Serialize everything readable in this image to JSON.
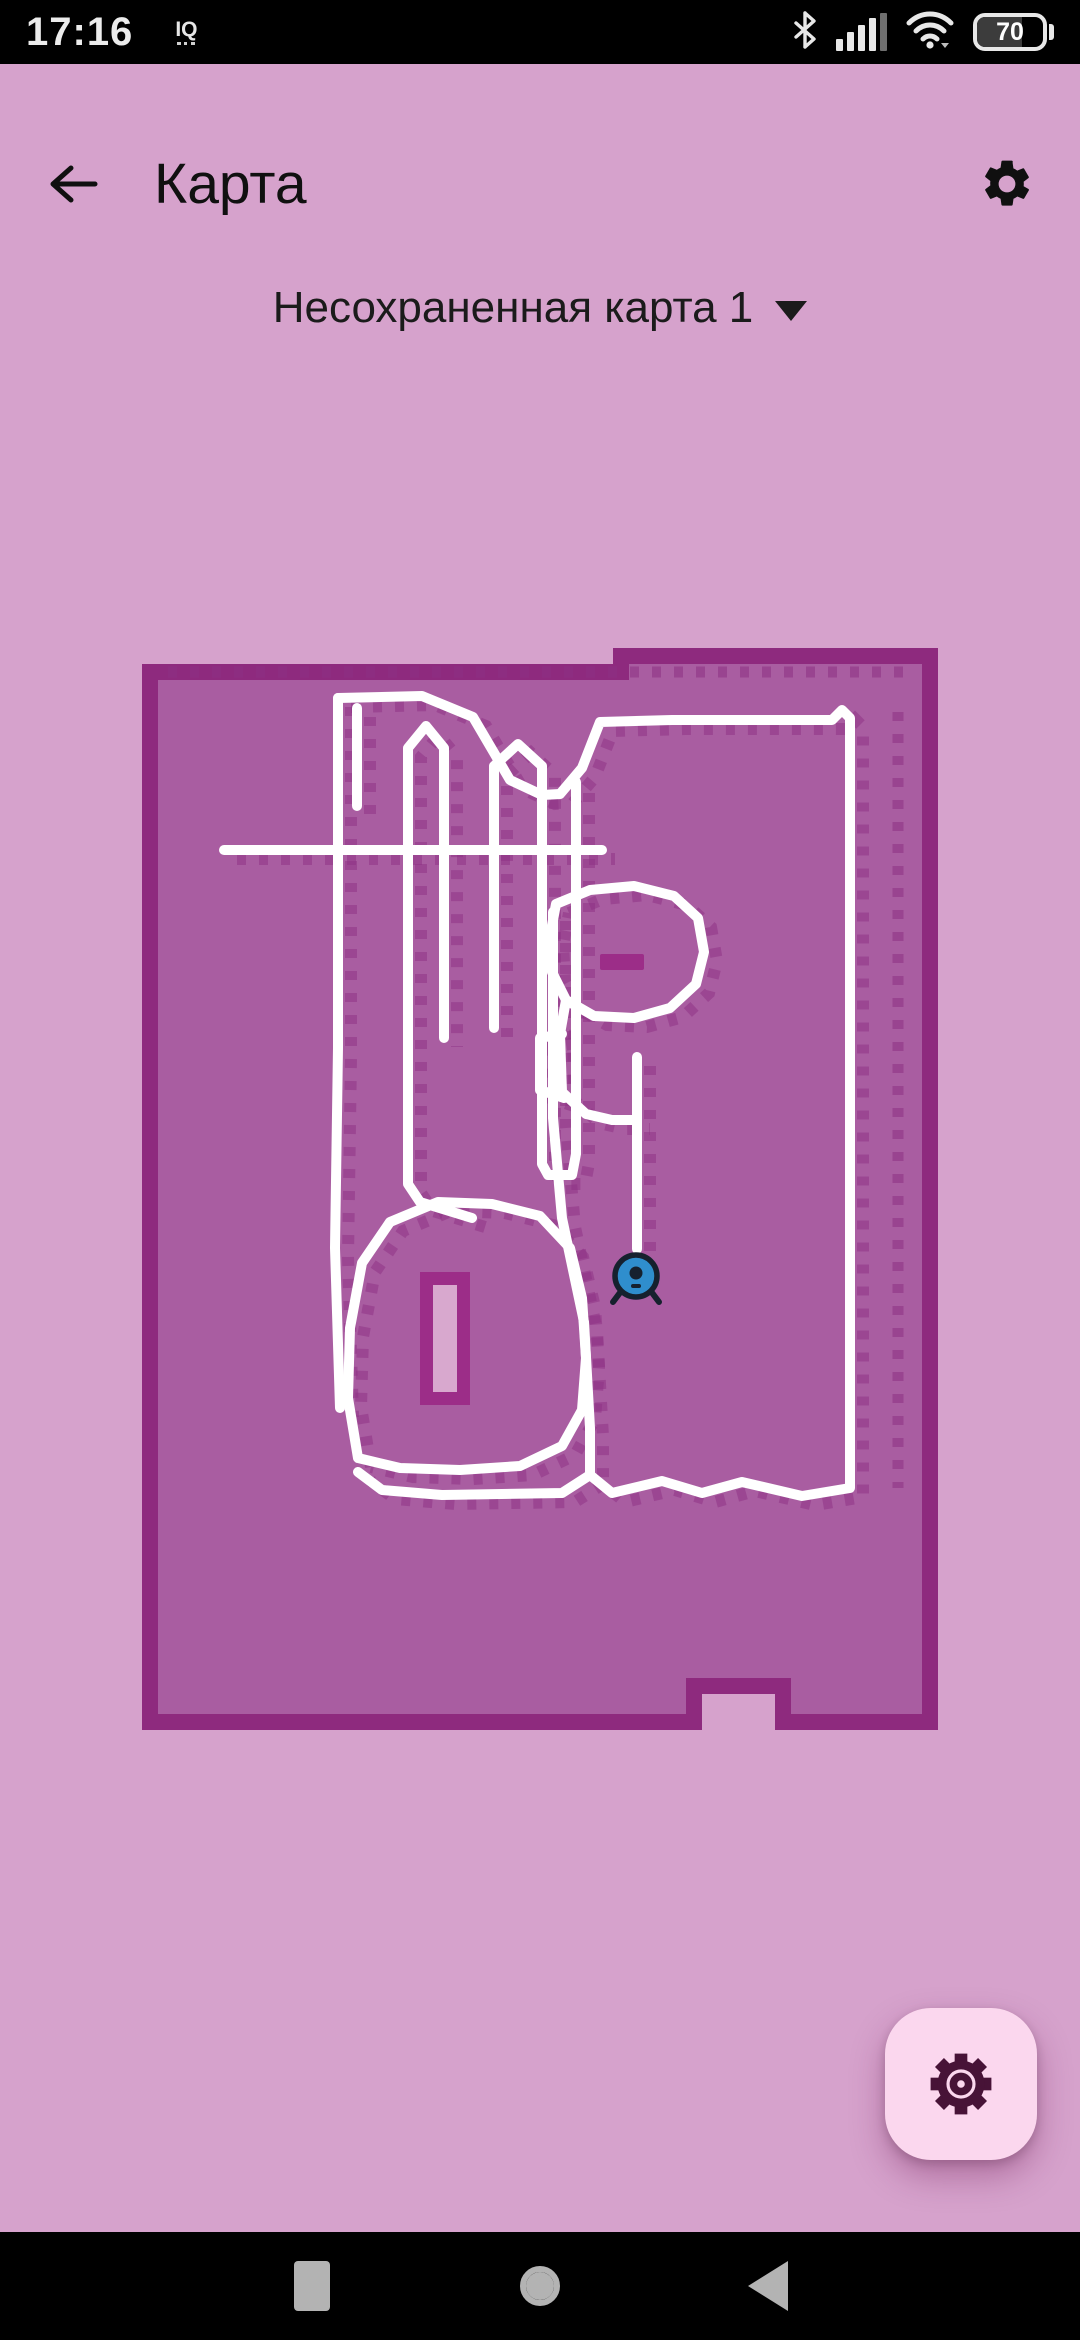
{
  "status_bar": {
    "time": "17:16",
    "notification": "IQ",
    "battery_percent": "70"
  },
  "header": {
    "title": "Карта"
  },
  "map_selector": {
    "label": "Несохраненная карта 1"
  },
  "map": {
    "colors": {
      "background": "#d6a2cc",
      "fill": "#a95da1",
      "border": "#8e2a7e",
      "path": "#ffffff",
      "texture": "#8d3084",
      "island_accent": "#9c2d88",
      "island_inner": "#d8a8ce",
      "robot_blue": "#2f8ecd",
      "robot_dark": "#16212e"
    },
    "outline_outer": [
      [
        0,
        16
      ],
      [
        471,
        16
      ],
      [
        471,
        0
      ],
      [
        796,
        0
      ],
      [
        796,
        1082
      ],
      [
        633,
        1082
      ],
      [
        633,
        1046
      ],
      [
        560,
        1046
      ],
      [
        560,
        1082
      ],
      [
        0,
        1082
      ]
    ],
    "outline_inner": [
      [
        16,
        32
      ],
      [
        487,
        32
      ],
      [
        487,
        16
      ],
      [
        780,
        16
      ],
      [
        780,
        1066
      ],
      [
        649,
        1066
      ],
      [
        649,
        1030
      ],
      [
        544,
        1030
      ],
      [
        544,
        1066
      ],
      [
        16,
        1066
      ]
    ],
    "texture_lines": [
      {
        "points": [
          [
            26,
            24
          ],
          [
            768,
            24
          ]
        ]
      },
      {
        "points": [
          [
            756,
            64
          ],
          [
            756,
            840
          ]
        ]
      }
    ],
    "path_polylines": [
      {
        "name": "outer-loop",
        "points": [
          [
            196,
            50
          ],
          [
            280,
            48
          ],
          [
            331,
            69
          ],
          [
            368,
            132
          ],
          [
            400,
            147
          ],
          [
            418,
            146
          ],
          [
            440,
            120
          ],
          [
            458,
            74
          ],
          [
            530,
            72
          ],
          [
            690,
            72
          ],
          [
            700,
            62
          ],
          [
            708,
            70
          ],
          [
            708,
            840
          ],
          [
            660,
            848
          ],
          [
            600,
            834
          ],
          [
            560,
            845
          ],
          [
            520,
            833
          ],
          [
            470,
            845
          ],
          [
            448,
            827
          ]
        ]
      },
      {
        "name": "bottom-line",
        "points": [
          [
            448,
            827
          ],
          [
            420,
            845
          ],
          [
            300,
            847
          ],
          [
            240,
            842
          ],
          [
            216,
            824
          ]
        ]
      },
      {
        "name": "left-vertical",
        "points": [
          [
            196,
            50
          ],
          [
            196,
            400
          ],
          [
            193,
            600
          ],
          [
            198,
            760
          ]
        ]
      },
      {
        "name": "left-vertical-2",
        "points": [
          [
            215,
            60
          ],
          [
            215,
            158
          ]
        ]
      },
      {
        "name": "stripe-1",
        "points": [
          [
            330,
            570
          ],
          [
            278,
            554
          ],
          [
            266,
            536
          ],
          [
            266,
            100
          ],
          [
            284,
            78
          ],
          [
            302,
            100
          ],
          [
            302,
            390
          ]
        ]
      },
      {
        "name": "stripe-2",
        "points": [
          [
            352,
            380
          ],
          [
            352,
            118
          ],
          [
            376,
            96
          ],
          [
            400,
            118
          ],
          [
            400,
            516
          ],
          [
            406,
            527
          ],
          [
            430,
            527
          ],
          [
            434,
            506
          ],
          [
            434,
            134
          ]
        ]
      },
      {
        "name": "mid-horizontal",
        "points": [
          [
            82,
            202
          ],
          [
            460,
            202
          ]
        ]
      },
      {
        "name": "center-slant",
        "points": [
          [
            411,
            264
          ],
          [
            411,
            470
          ],
          [
            420,
            570
          ],
          [
            442,
            674
          ],
          [
            448,
            780
          ],
          [
            448,
            827
          ]
        ]
      },
      {
        "name": "island-loop",
        "points": [
          [
            414,
            256
          ],
          [
            448,
            242
          ],
          [
            492,
            238
          ],
          [
            532,
            248
          ],
          [
            556,
            270
          ],
          [
            562,
            304
          ],
          [
            554,
            336
          ],
          [
            528,
            360
          ],
          [
            492,
            370
          ],
          [
            452,
            368
          ],
          [
            424,
            352
          ],
          [
            410,
            324
          ],
          [
            408,
            288
          ],
          [
            414,
            256
          ]
        ]
      },
      {
        "name": "island-notch",
        "points": [
          [
            420,
            386
          ],
          [
            398,
            390
          ],
          [
            398,
            442
          ],
          [
            422,
            450
          ]
        ]
      },
      {
        "name": "island-connector",
        "points": [
          [
            424,
            352
          ],
          [
            418,
            386
          ],
          [
            420,
            444
          ],
          [
            444,
            466
          ],
          [
            470,
            472
          ],
          [
            495,
            472
          ]
        ]
      },
      {
        "name": "robot-line",
        "points": [
          [
            495,
            409
          ],
          [
            495,
            601
          ]
        ]
      },
      {
        "name": "blob-loop",
        "points": [
          [
            216,
            810
          ],
          [
            206,
            750
          ],
          [
            208,
            680
          ],
          [
            220,
            615
          ],
          [
            248,
            574
          ],
          [
            296,
            554
          ],
          [
            350,
            556
          ],
          [
            398,
            568
          ],
          [
            428,
            600
          ],
          [
            440,
            650
          ],
          [
            444,
            710
          ],
          [
            440,
            762
          ],
          [
            420,
            798
          ],
          [
            378,
            818
          ],
          [
            318,
            822
          ],
          [
            258,
            820
          ],
          [
            216,
            810
          ]
        ]
      }
    ],
    "island_bar": {
      "x": 458,
      "y": 306,
      "w": 44,
      "h": 16
    },
    "blob_rect": {
      "x": 278,
      "y": 624,
      "w": 50,
      "h": 133,
      "inner_inset": 13
    },
    "robot": {
      "cx": 494,
      "cy": 628,
      "r": 21
    }
  },
  "fab": {
    "icon": "gear"
  },
  "nav_bar": {
    "buttons": [
      "recents",
      "home",
      "back"
    ]
  }
}
